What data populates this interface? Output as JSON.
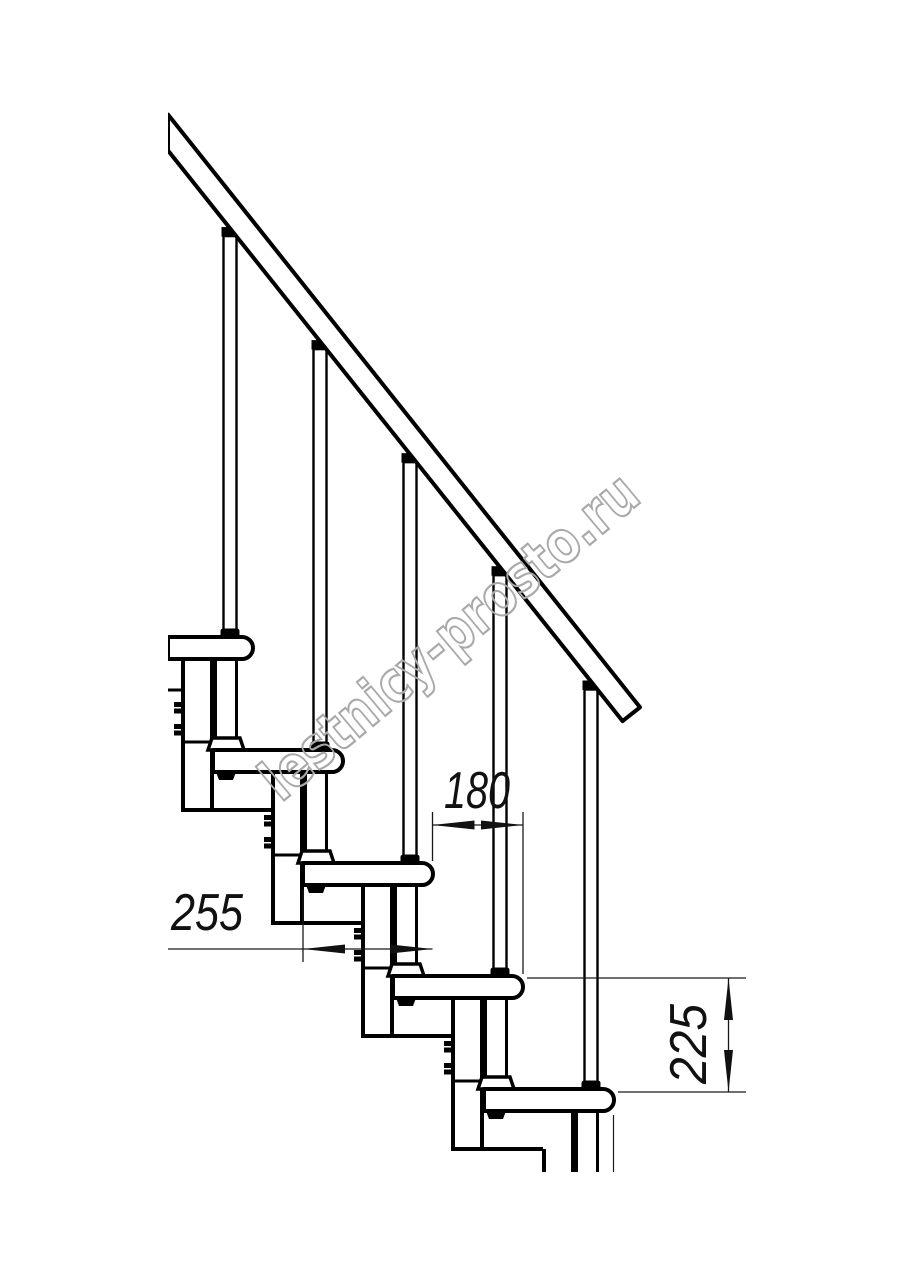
{
  "page": {
    "background": "#ffffff",
    "kind": "technical line drawing",
    "subject": "modular staircase side elevation with handrail and balusters"
  },
  "drawing": {
    "line_color": "#000000",
    "fill_color": "#ffffff",
    "tread_count": 5,
    "baluster_count": 5,
    "handrail": "diagonal handrail band descending left-to-right",
    "details": [
      "module boxes with side bolts",
      "nose support posts with feet and nuts",
      "black baluster mounting caps"
    ]
  },
  "dimensions": {
    "run": {
      "value": "180"
    },
    "tread_depth": {
      "value": "255"
    },
    "rise": {
      "value": "225"
    },
    "arrow_color": "#111111",
    "line_color": "#1a1a1a"
  },
  "watermark": {
    "text": "lestnicy-prosto.ru",
    "color": "#a9a9a9"
  }
}
